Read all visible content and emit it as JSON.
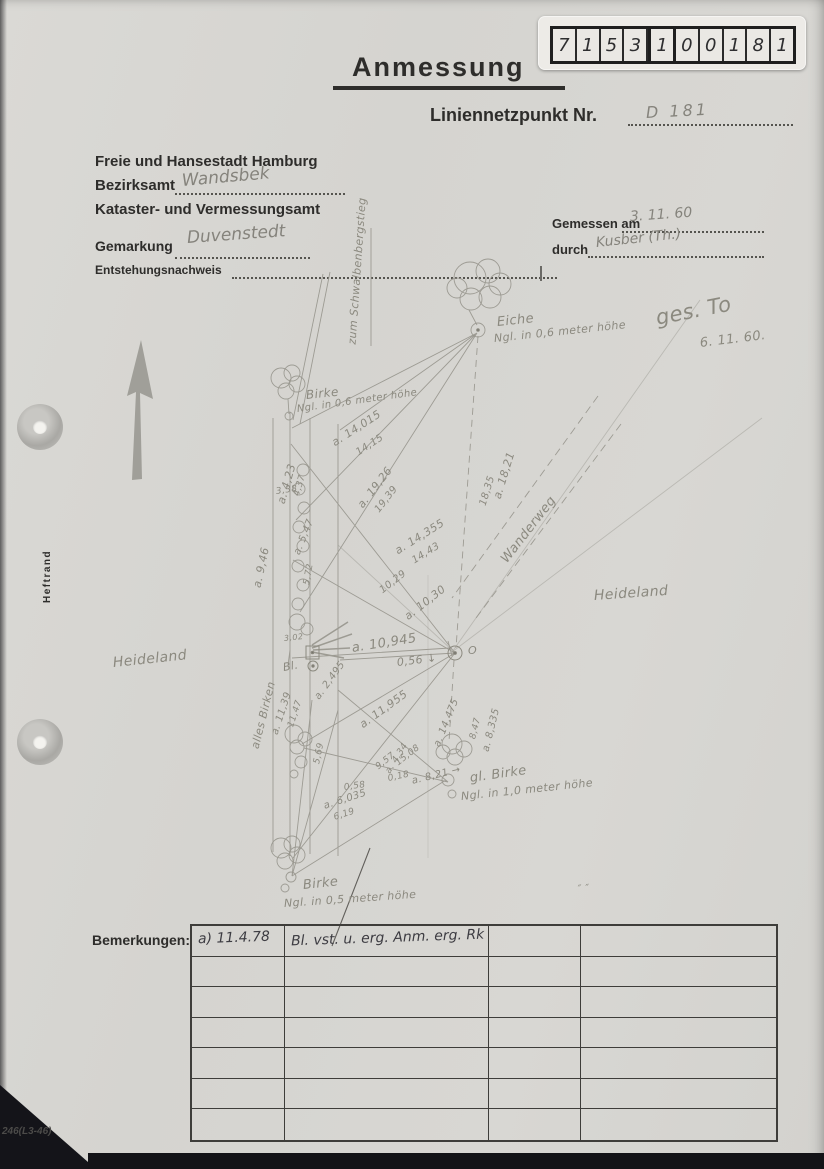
{
  "colors": {
    "paper": "#d6d5d1",
    "pencil": "#8b897f",
    "ink": "#3d3c42",
    "print": "#2e2d2b"
  },
  "stamp": {
    "digits": [
      "7",
      "1",
      "5",
      "3",
      "1",
      "0",
      "0",
      "1",
      "8",
      "1"
    ]
  },
  "header": {
    "title": "Anmessung",
    "point_label": "Liniennetzpunkt Nr.",
    "point_value": "D 181",
    "agency_line1": "Freie und Hansestadt Hamburg",
    "bezirksamt_label": "Bezirksamt",
    "bezirksamt_value": "Wandsbek",
    "agency_line3": "Kataster- und Vermessungsamt",
    "gemarkung_label": "Gemarkung",
    "gemarkung_value": "Duvenstedt",
    "entstehung_label": "Entstehungsnachweis",
    "gemessen_label": "Gemessen am",
    "gemessen_value": "3. 11. 60",
    "durch_label": "durch",
    "durch_value": "Kusber (Th.)"
  },
  "margin": {
    "heftrand": "Heftrand",
    "form_code": "246(L3-46)"
  },
  "sketch": {
    "labels": [
      {
        "text": "zum Schwalbenbergstieg",
        "x": 352,
        "y": 338,
        "rot": -86,
        "size": 11
      },
      {
        "text": "Eiche",
        "x": 497,
        "y": 315,
        "rot": -6,
        "size": 13
      },
      {
        "text": "Ngl. in 0,6 meter höhe",
        "x": 494,
        "y": 332,
        "rot": -6,
        "size": 11
      },
      {
        "text": "Birke",
        "x": 306,
        "y": 388,
        "rot": -6,
        "size": 12
      },
      {
        "text": "Ngl. in 0,6 meter höhe",
        "x": 297,
        "y": 404,
        "rot": -8,
        "size": 10
      },
      {
        "text": "a. 14,015",
        "x": 333,
        "y": 437,
        "rot": -33,
        "size": 11
      },
      {
        "text": "14,15",
        "x": 357,
        "y": 448,
        "rot": -33,
        "size": 10
      },
      {
        "text": "a. 4,23",
        "x": 281,
        "y": 497,
        "rot": -74,
        "size": 11
      },
      {
        "text": "4,37",
        "x": 297,
        "y": 491,
        "rot": -74,
        "size": 9
      },
      {
        "text": "3,38",
        "x": 276,
        "y": 487,
        "rot": -8,
        "size": 9
      },
      {
        "text": "a. 19,26",
        "x": 360,
        "y": 500,
        "rot": -52,
        "size": 11
      },
      {
        "text": "19,39",
        "x": 377,
        "y": 506,
        "rot": -52,
        "size": 10
      },
      {
        "text": "a. 18,21",
        "x": 497,
        "y": 492,
        "rot": -73,
        "size": 11
      },
      {
        "text": "18,35",
        "x": 483,
        "y": 500,
        "rot": -73,
        "size": 10
      },
      {
        "text": "a. 14,355",
        "x": 396,
        "y": 545,
        "rot": -32,
        "size": 11
      },
      {
        "text": "14,43",
        "x": 413,
        "y": 556,
        "rot": -32,
        "size": 10
      },
      {
        "text": "a. 9,46",
        "x": 257,
        "y": 581,
        "rot": -78,
        "size": 11
      },
      {
        "text": "a. 5,47",
        "x": 297,
        "y": 549,
        "rot": -68,
        "size": 10
      },
      {
        "text": "5,72",
        "x": 307,
        "y": 580,
        "rot": -80,
        "size": 9
      },
      {
        "text": "10,29",
        "x": 381,
        "y": 586,
        "rot": -38,
        "size": 10
      },
      {
        "text": "a. 10,30",
        "x": 406,
        "y": 611,
        "rot": -38,
        "size": 11
      },
      {
        "text": "a. 10,945",
        "x": 352,
        "y": 641,
        "rot": -9,
        "size": 13
      },
      {
        "text": "0,56 ↓",
        "x": 397,
        "y": 656,
        "rot": -7,
        "size": 11
      },
      {
        "text": "Wanderweg",
        "x": 504,
        "y": 554,
        "rot": -52,
        "size": 13
      },
      {
        "text": "Heideland",
        "x": 594,
        "y": 588,
        "rot": -4,
        "size": 14
      },
      {
        "text": "Heideland",
        "x": 113,
        "y": 655,
        "rot": -6,
        "size": 14
      },
      {
        "text": "alles Birken",
        "x": 255,
        "y": 742,
        "rot": -76,
        "size": 11
      },
      {
        "text": "Bl.",
        "x": 283,
        "y": 661,
        "rot": -10,
        "size": 11
      },
      {
        "text": "a. 11,39",
        "x": 275,
        "y": 729,
        "rot": -72,
        "size": 10
      },
      {
        "text": "11,47",
        "x": 291,
        "y": 722,
        "rot": -72,
        "size": 9
      },
      {
        "text": "a. 2,495",
        "x": 317,
        "y": 693,
        "rot": -54,
        "size": 10
      },
      {
        "text": "5,69",
        "x": 317,
        "y": 759,
        "rot": -78,
        "size": 9
      },
      {
        "text": "a. 11,955",
        "x": 361,
        "y": 719,
        "rot": -36,
        "size": 11
      },
      {
        "text": "a. 14,475",
        "x": 437,
        "y": 741,
        "rot": -68,
        "size": 10
      },
      {
        "text": "a. 8,335",
        "x": 486,
        "y": 746,
        "rot": -76,
        "size": 10
      },
      {
        "text": "8,47",
        "x": 473,
        "y": 734,
        "rot": -76,
        "size": 9
      },
      {
        "text": "15,08",
        "x": 397,
        "y": 759,
        "rot": -38,
        "size": 9
      },
      {
        "text": "9,57",
        "x": 377,
        "y": 763,
        "rot": -38,
        "size": 9
      },
      {
        "text": "a. 4,34",
        "x": 388,
        "y": 768,
        "rot": -58,
        "size": 9
      },
      {
        "text": "0,18",
        "x": 388,
        "y": 774,
        "rot": -12,
        "size": 9
      },
      {
        "text": "a. 8,21 →",
        "x": 412,
        "y": 776,
        "rot": -14,
        "size": 10
      },
      {
        "text": "0,58",
        "x": 344,
        "y": 783,
        "rot": -8,
        "size": 9
      },
      {
        "text": "a. 6,035",
        "x": 324,
        "y": 801,
        "rot": -18,
        "size": 10
      },
      {
        "text": "6,19",
        "x": 334,
        "y": 813,
        "rot": -18,
        "size": 9
      },
      {
        "text": "gl. Birke",
        "x": 470,
        "y": 771,
        "rot": -8,
        "size": 13
      },
      {
        "text": "Ngl. in 1,0 meter höhe",
        "x": 461,
        "y": 790,
        "rot": -6,
        "size": 11
      },
      {
        "text": "Birke",
        "x": 303,
        "y": 878,
        "rot": -6,
        "size": 13
      },
      {
        "text": "Ngl. in 0,5 meter höhe",
        "x": 284,
        "y": 897,
        "rot": -4,
        "size": 11
      },
      {
        "text": "O",
        "x": 468,
        "y": 644,
        "rot": 0,
        "size": 11
      },
      {
        "text": "3,02",
        "x": 284,
        "y": 634,
        "rot": -6,
        "size": 8
      },
      {
        "text": "″ ″",
        "x": 578,
        "y": 884,
        "rot": -5,
        "size": 10
      },
      {
        "text": "ges. To",
        "x": 656,
        "y": 306,
        "rot": -11,
        "size": 21
      },
      {
        "text": "6. 11. 60.",
        "x": 700,
        "y": 336,
        "rot": -7,
        "size": 13
      }
    ]
  },
  "remarks": {
    "label": "Bemerkungen:",
    "rows": [
      [
        "a) 11.4.78",
        "Bl. vst. u. erg. Anm. erg. Rk",
        "",
        ""
      ],
      [
        "",
        "",
        "",
        ""
      ],
      [
        "",
        "",
        "",
        ""
      ],
      [
        "",
        "",
        "",
        ""
      ],
      [
        "",
        "",
        "",
        ""
      ],
      [
        "",
        "",
        "",
        ""
      ],
      [
        "",
        "",
        "",
        ""
      ]
    ]
  }
}
